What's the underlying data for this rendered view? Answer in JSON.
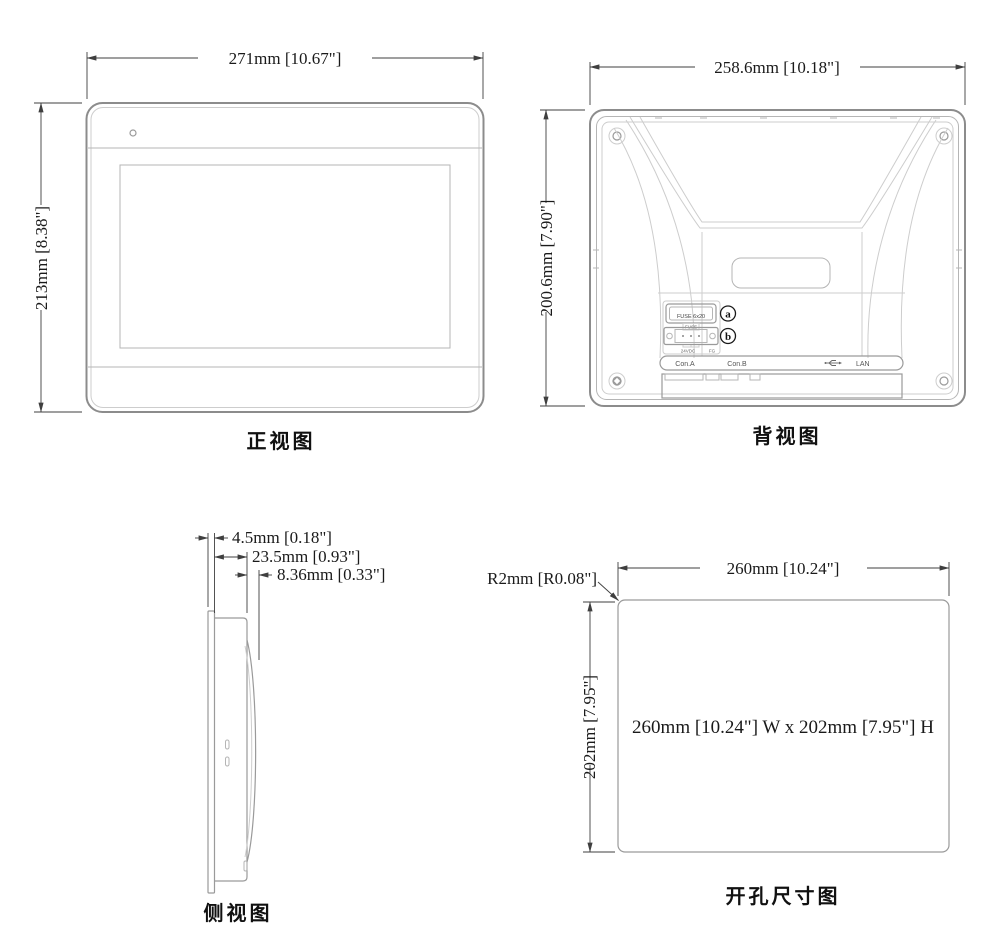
{
  "colors": {
    "outline": "#8c8c8c",
    "inner_line": "#b5b5b5",
    "faint_line": "#cdcdcd",
    "dimension": "#3f3f3f",
    "text": "#1a1a1a"
  },
  "front_view": {
    "label": "正视图",
    "width_dim": "271mm [10.67\"]",
    "height_dim": "213mm [8.38\"]"
  },
  "back_view": {
    "label": "背视图",
    "width_dim": "258.6mm [10.18\"]",
    "height_dim": "200.6mm [7.90\"]",
    "fuse_box_label": "FUSE 6x20",
    "fuse_caption": "FUSE",
    "callout_a": "a",
    "callout_b": "b",
    "power_label_24vdc": "24VDC",
    "power_label_fg": "FG",
    "port_con_a": "Con.A",
    "port_con_b": "Con.B",
    "port_lan": "LAN"
  },
  "side_view": {
    "label": "侧视图",
    "dim_bezel": "4.5mm [0.18\"]",
    "dim_depth": "23.5mm [0.93\"]",
    "dim_rear": "8.36mm [0.33\"]"
  },
  "cutout_view": {
    "label": "开孔尺寸图",
    "width_dim": "260mm [10.24\"]",
    "height_dim": "202mm [7.95\"]",
    "corner_radius_dim": "R2mm [R0.08\"]",
    "center_text": "260mm [10.24\"] W x 202mm [7.95\"] H"
  }
}
